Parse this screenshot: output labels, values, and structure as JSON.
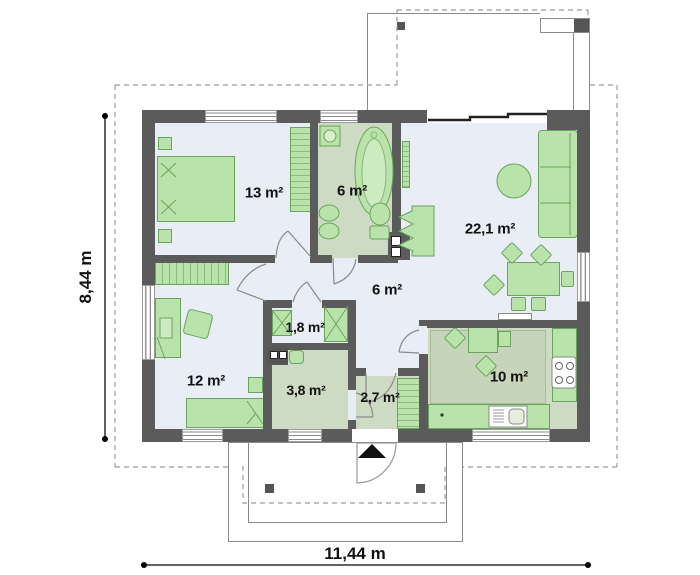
{
  "plan_title": "single-storey house floor plan",
  "rooms": {
    "bedroom_main": {
      "name": "bedroom",
      "area": "13 m²"
    },
    "bathroom": {
      "name": "bathroom",
      "area": "6 m²"
    },
    "living_room": {
      "name": "living room",
      "area": "22,1 m²"
    },
    "hall": {
      "name": "hall",
      "area": "6 m²"
    },
    "closet": {
      "name": "closet",
      "area": "1,8 m²"
    },
    "bedroom_second": {
      "name": "bedroom",
      "area": "12 m²"
    },
    "utility": {
      "name": "utility",
      "area": "3,8 m²"
    },
    "vestibule": {
      "name": "vestibule",
      "area": "2,7 m²"
    },
    "kitchen": {
      "name": "kitchen",
      "area": "10 m²"
    }
  },
  "dimensions": {
    "height": "8,44 m",
    "width": "11,44 m"
  },
  "icons": {
    "entrance_arrow": "black triangle pointing up at main entrance"
  },
  "colors": {
    "wall": "#5b5b5b",
    "floor_light": "#e9edf5",
    "floor_green": "#cedbc4",
    "furniture_fill": "#b9e3ab",
    "furniture_border": "#6aa35b",
    "dashed_outline": "#9b9b9b"
  }
}
